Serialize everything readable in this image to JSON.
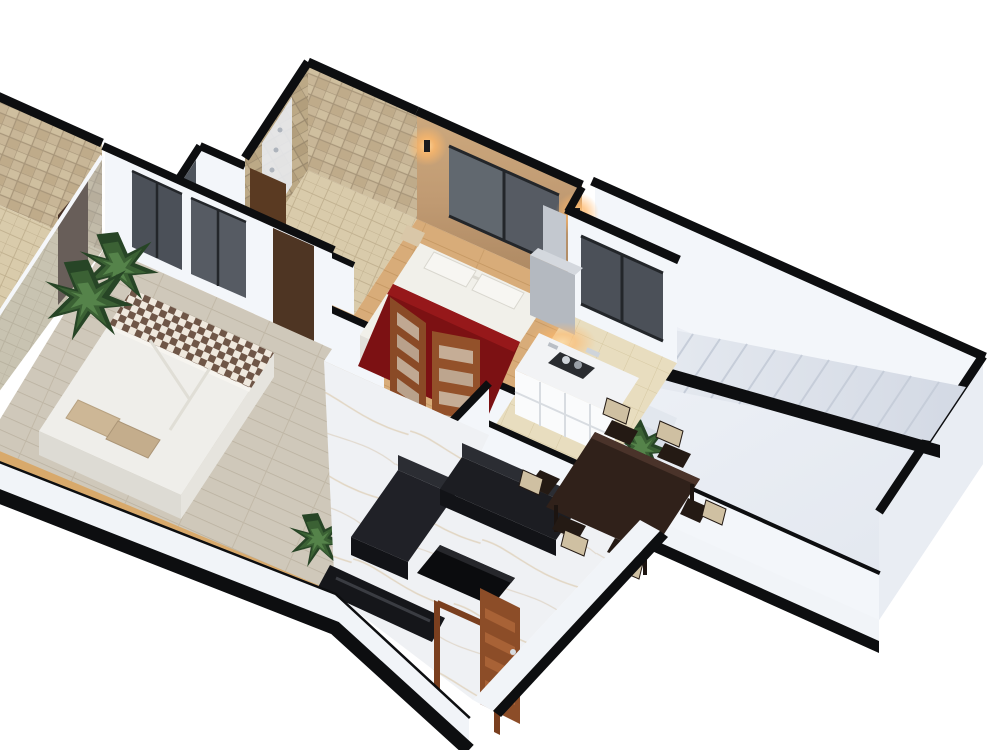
{
  "scene": {
    "type": "3d-isometric-floor-plan-render",
    "view": "cutaway-birds-eye",
    "background": "#ffffff",
    "wall_style": "white-walls-with-black-cut-caps",
    "rooms": [
      {
        "name": "master-bedroom",
        "floor": "oak-wood-planks",
        "objects": [
          "double-bed-white-duvet-maroon-throw",
          "white-pillows",
          "beige-side-steps",
          "tan-accent-wall",
          "sliding-glass-window",
          "two-wall-sconces-warm-glow",
          "open-wood-glass-double-doors"
        ]
      },
      {
        "name": "bedroom-two",
        "floor": "grey-wood-planks",
        "objects": [
          "double-bed-white-duvet-checkered-throw",
          "beige-pillows",
          "corner-palm-plants",
          "window-wall-dark-glass",
          "wood-door",
          "tan-ledge-strip",
          "small-plant"
        ]
      },
      {
        "name": "master-bathroom",
        "walls": "beige-stone-tile",
        "objects": [
          "rain-shower-panel",
          "tiled-floor",
          "half-wall",
          "wood-door"
        ]
      },
      {
        "name": "second-bathroom",
        "walls": "beige-stone-tile",
        "objects": [
          "shower-panel",
          "glass-screen",
          "tiled-floor",
          "dark-wood-door"
        ]
      },
      {
        "name": "kitchen",
        "floor": "cream-ceramic-tile",
        "objects": [
          "white-cabinet-run",
          "dark-hob-with-steel-cookware",
          "grey-chimney-hood",
          "interior-window-dark-glass",
          "under-cabinet-warm-light",
          "low-black-kick-wall"
        ]
      },
      {
        "name": "living-room",
        "floor": "white-marble",
        "objects": [
          "l-shaped-dark-sofa-set",
          "black-coffee-table",
          "dark-tv-console",
          "open-slatted-entrance-door",
          "wood-door-frame"
        ]
      },
      {
        "name": "dining-area",
        "floor": "white-marble",
        "objects": [
          "dark-wood-six-seat-table",
          "upholstered-beige-back-chairs",
          "corner-plant-pocket"
        ]
      },
      {
        "name": "stair-hall",
        "floor": "pale-grey-screed",
        "objects": [
          "lower-entry-steps",
          "long-upper-stair-flight",
          "sloped-black-parapet",
          "black-baluster-dots",
          "corner-plant"
        ]
      }
    ],
    "palette": {
      "background": "#ffffff",
      "wall_cap_black": "#0d0e10",
      "white_wall": "#f3f6fa",
      "tile_beige": "#c8b697",
      "tile_grout": "#a8967a",
      "tan_accent_wall": "#c09a72",
      "sconce_glow": "#ffb869",
      "oak_floor": "#d8ac79",
      "grey_plank_floor": "#cfc8ba",
      "kitchen_floor": "#e8ddbf",
      "marble_floor": "#eff1f4",
      "hall_floor": "#e9edf3",
      "stair_step": "#dde2ea",
      "bed_red": "#7c1113",
      "fabric_white": "#f1f0ea",
      "pillow_beige": "#cdb796",
      "checker_dark": "#6f5647",
      "checker_light": "#efe8dd",
      "sofa_dark": "#1b1c20",
      "coffee_table_black": "#0b0c0e",
      "dining_table_brown": "#30211a",
      "chair_pad": "#cfc0a2",
      "door_wood": "#8c4d28",
      "window_glass": "#565b63",
      "plant_green": "#2e4a2a",
      "steel": "#cfd4da",
      "ledge_wood": "#d8a96b",
      "chimney_grey": "#b4b9c0"
    }
  }
}
